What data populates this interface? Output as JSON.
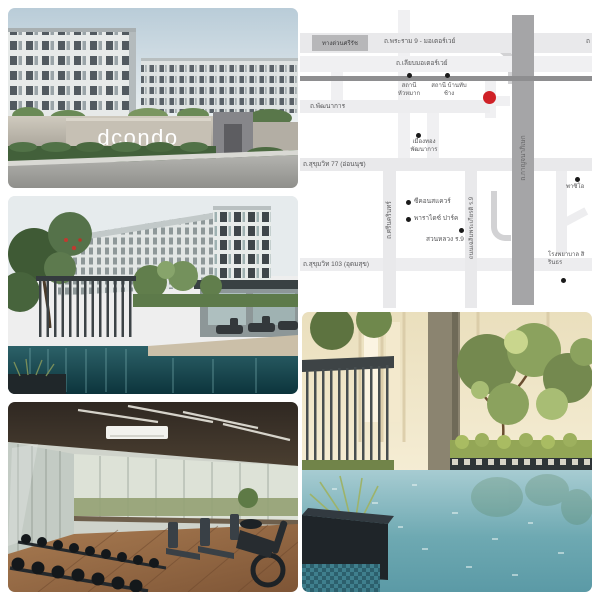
{
  "sign": {
    "text": "dcondo"
  },
  "map": {
    "colors": {
      "marker": "#cf2127",
      "road_light": "#e9e9eb",
      "railway": "#8e8e90",
      "highway": "#a5a5a7",
      "label_box": "#b7b7b9",
      "text": "#58585a"
    },
    "labels": {
      "expressway": "ทางด่วนศรีรัช",
      "rama9": "ถ.พระราม 9 - มอเตอร์เวย์",
      "rama9_cut": "ถ",
      "liap_motorway": "ถ.เลียบมอเตอร์เวย์",
      "station_huamak": "สถานี หัวหมาก",
      "station_banthapchang": "สถานี บ้านทับช้าง",
      "pattanakarn": "ถ.พัฒนาการ",
      "mueangthong": "เมืองทอง พัฒนาการ",
      "sukhumvit77": "ถ.สุขุมวิท 77 (อ่อนนุช)",
      "srinakarin": "ถ.ศรีนครินทร์",
      "seacon": "ซีคอนสแควร์",
      "paradise": "พาราไดซ์ ปาร์ค",
      "suanluang": "สวนหลวง ร.9",
      "chalermprakiat": "ถนนเฉลิมพระเกียรติ ร.9",
      "sukhumvit103": "ถ.สุขุมวิท 103 (อุดมสุข)",
      "kanchanaphisek": "ถ.กาญจนาภิเษก",
      "paseo": "พาซิโอ",
      "hospital": "โรงพยาบาล สิรินธร"
    }
  }
}
